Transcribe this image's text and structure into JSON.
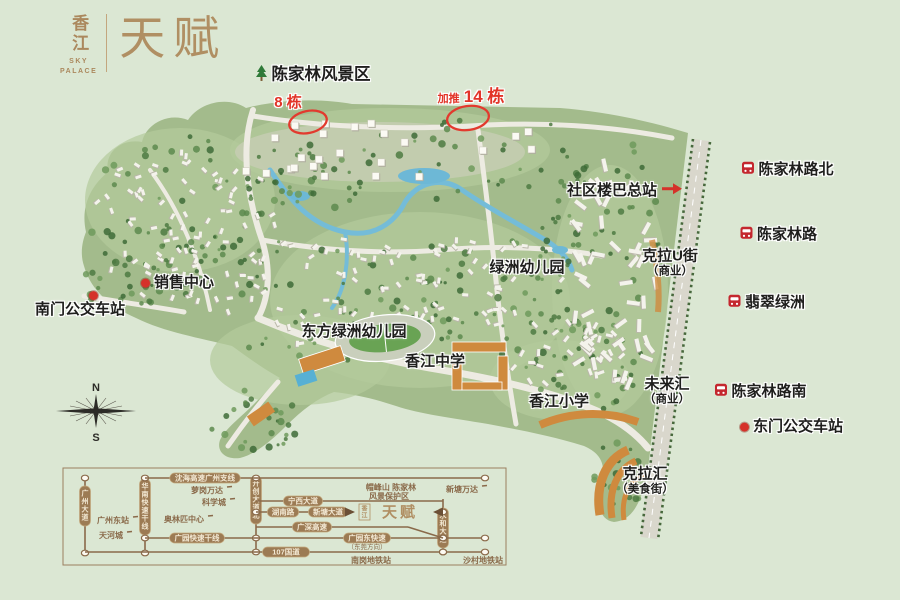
{
  "logo": {
    "brand_cn": "香江",
    "brand_en": "SKY\nPALACE",
    "name": "天赋"
  },
  "colors": {
    "accent_red": "#e23428",
    "brand_tan": "#b08f63",
    "bus_red": "#c4272e",
    "diagram_brown": "#8a6a4a",
    "background_green": "#dbe7d3"
  },
  "compass": {
    "north": "N",
    "south": "S"
  },
  "map": {
    "labels": [
      {
        "id": "scenic-area",
        "text": "陈家林风景区",
        "x": 321,
        "y": 75,
        "style": "title",
        "marker": "tree"
      },
      {
        "id": "block-8",
        "text": "8 栋",
        "x": 288,
        "y": 103,
        "style": "red"
      },
      {
        "id": "block-14",
        "text": "14 栋",
        "x": 471,
        "y": 97,
        "style": "red",
        "prefix": "加推"
      },
      {
        "id": "community-bus-terminal",
        "text": "社区楼巴总站",
        "x": 612,
        "y": 191,
        "style": "dark",
        "marker": "arrow-right"
      },
      {
        "id": "chenjialin-road-north",
        "text": "陈家林路北",
        "x": 796,
        "y": 170,
        "style": "dark",
        "marker": "bus"
      },
      {
        "id": "chenjialin-road",
        "text": "陈家林路",
        "x": 787,
        "y": 235,
        "style": "dark",
        "marker": "bus"
      },
      {
        "id": "kela-u-street",
        "text": "克拉U街",
        "sub": "（商业）",
        "x": 670,
        "y": 263,
        "style": "dark"
      },
      {
        "id": "feicui-lvzhou",
        "text": "翡翠绿洲",
        "x": 775,
        "y": 303,
        "style": "dark",
        "marker": "bus"
      },
      {
        "id": "lvzhou-kindergarten",
        "text": "绿洲幼儿园",
        "x": 527,
        "y": 268,
        "style": "dark"
      },
      {
        "id": "sales-center",
        "text": "销售中心",
        "x": 184,
        "y": 283,
        "style": "dark",
        "marker": "dot-left"
      },
      {
        "id": "south-gate-bus-station",
        "text": "南门公交车站",
        "x": 80,
        "y": 310,
        "style": "dark",
        "marker": "dot-top"
      },
      {
        "id": "dongfang-kindergarten",
        "text": "东方绿洲幼儿园",
        "x": 354,
        "y": 332,
        "style": "dark"
      },
      {
        "id": "xiangjiang-middle-school",
        "text": "香江中学",
        "x": 435,
        "y": 362,
        "style": "dark"
      },
      {
        "id": "xiangjiang-primary-school",
        "text": "香江小学",
        "x": 559,
        "y": 402,
        "style": "dark"
      },
      {
        "id": "weilaihui",
        "text": "未来汇",
        "sub": "（商业）",
        "x": 667,
        "y": 391,
        "style": "dark"
      },
      {
        "id": "chenjialin-road-south",
        "text": "陈家林路南",
        "x": 769,
        "y": 392,
        "style": "dark",
        "marker": "bus"
      },
      {
        "id": "east-gate-bus-station",
        "text": "东门公交车站",
        "x": 798,
        "y": 427,
        "style": "dark",
        "marker": "dot-left"
      },
      {
        "id": "kelahui",
        "text": "克拉汇",
        "sub": "（美食街）",
        "x": 645,
        "y": 481,
        "style": "dark"
      }
    ],
    "highlights": [
      {
        "id": "block-8-circle",
        "cx": 308,
        "cy": 122,
        "rx": 19,
        "ry": 11,
        "rot": -12
      },
      {
        "id": "block-14-circle",
        "cx": 468,
        "cy": 118,
        "rx": 21,
        "ry": 12,
        "rot": -8
      }
    ]
  },
  "transit": {
    "roads": [
      {
        "id": "guangzhou-ave",
        "type": "v",
        "x": 85,
        "y1": 478,
        "y2": 553,
        "nodes": [
          478,
          553
        ],
        "pills": [
          {
            "text": "广州大道",
            "c": 506
          }
        ]
      },
      {
        "id": "huanan-expwy",
        "type": "v",
        "x": 145,
        "y1": 478,
        "y2": 553,
        "nodes": [
          478,
          538,
          553
        ],
        "pills": [
          {
            "text": "华南快速干线",
            "c": 507
          }
        ]
      },
      {
        "id": "kaichuang-ave",
        "type": "v",
        "x": 256,
        "y1": 478,
        "y2": 552,
        "nodes": [
          478,
          512,
          538,
          552
        ],
        "pills": [
          {
            "text": "开创大道北",
            "c": 500
          }
        ]
      },
      {
        "id": "yonghe-ave",
        "type": "v",
        "x": 443,
        "y1": 499,
        "y2": 552,
        "nodes": [
          512,
          538,
          552
        ],
        "pills": [
          {
            "text": "永和大道",
            "c": 528
          }
        ]
      },
      {
        "id": "shenhai-expwy",
        "type": "h",
        "y": 478,
        "x1": 145,
        "x2": 485,
        "nodes": [
          485
        ],
        "pills": [
          {
            "text": "沈海高速广州支线",
            "c": 205
          }
        ]
      },
      {
        "id": "ningxi-ave",
        "type": "h",
        "y": 501,
        "x1": 256,
        "x2": 443,
        "nodes": [],
        "pills": [
          {
            "text": "宁西大道",
            "c": 303
          }
        ]
      },
      {
        "id": "tianfu-row",
        "type": "h",
        "y": 512,
        "x1": 256,
        "x2": 352,
        "nodes": [],
        "pills": [
          {
            "text": "湖南路",
            "c": 283
          },
          {
            "text": "新塘大道",
            "c": 328
          }
        ]
      },
      {
        "id": "guangshen-expwy",
        "type": "h",
        "y": 527,
        "x1": 256,
        "x2": 408,
        "nodes": [],
        "pills": [
          {
            "text": "广深高速",
            "c": 312
          }
        ]
      },
      {
        "id": "guangyuan-expwy",
        "type": "h",
        "y": 538,
        "x1": 145,
        "x2": 485,
        "nodes": [
          443,
          485
        ],
        "pills": [
          {
            "text": "广园快速干线",
            "c": 197
          },
          {
            "text": "广园东快速",
            "c": 367,
            "sub": "（东莞方向）"
          }
        ]
      },
      {
        "id": "g107",
        "type": "h",
        "y": 552,
        "x1": 85,
        "x2": 485,
        "nodes": [
          443,
          485
        ],
        "pills": [
          {
            "text": "107国道",
            "c": 286
          }
        ]
      }
    ],
    "labels": [
      {
        "text": "广州东站",
        "x": 113,
        "y": 520,
        "dash": true
      },
      {
        "text": "天河城",
        "x": 111,
        "y": 535,
        "dash": true
      },
      {
        "text": "萝岗万达",
        "x": 207,
        "y": 490,
        "dash": true
      },
      {
        "text": "科学城",
        "x": 214,
        "y": 502,
        "dash": true
      },
      {
        "text": "奥林匹中心",
        "x": 184,
        "y": 519,
        "dash": true
      },
      {
        "text": "帽峰山 陈家林",
        "x": 391,
        "y": 487
      },
      {
        "text": "风景保护区",
        "x": 389,
        "y": 496
      },
      {
        "text": "新塘万达",
        "x": 462,
        "y": 489,
        "dash": true
      },
      {
        "text": "南岗地铁站",
        "x": 371,
        "y": 560
      },
      {
        "text": "沙村地铁站",
        "x": 483,
        "y": 560
      }
    ],
    "logo_row": {
      "brand_small": "香江",
      "brand": "天赋",
      "y": 512,
      "x_arrow_in": 352,
      "x_arrow_out": 436
    }
  }
}
